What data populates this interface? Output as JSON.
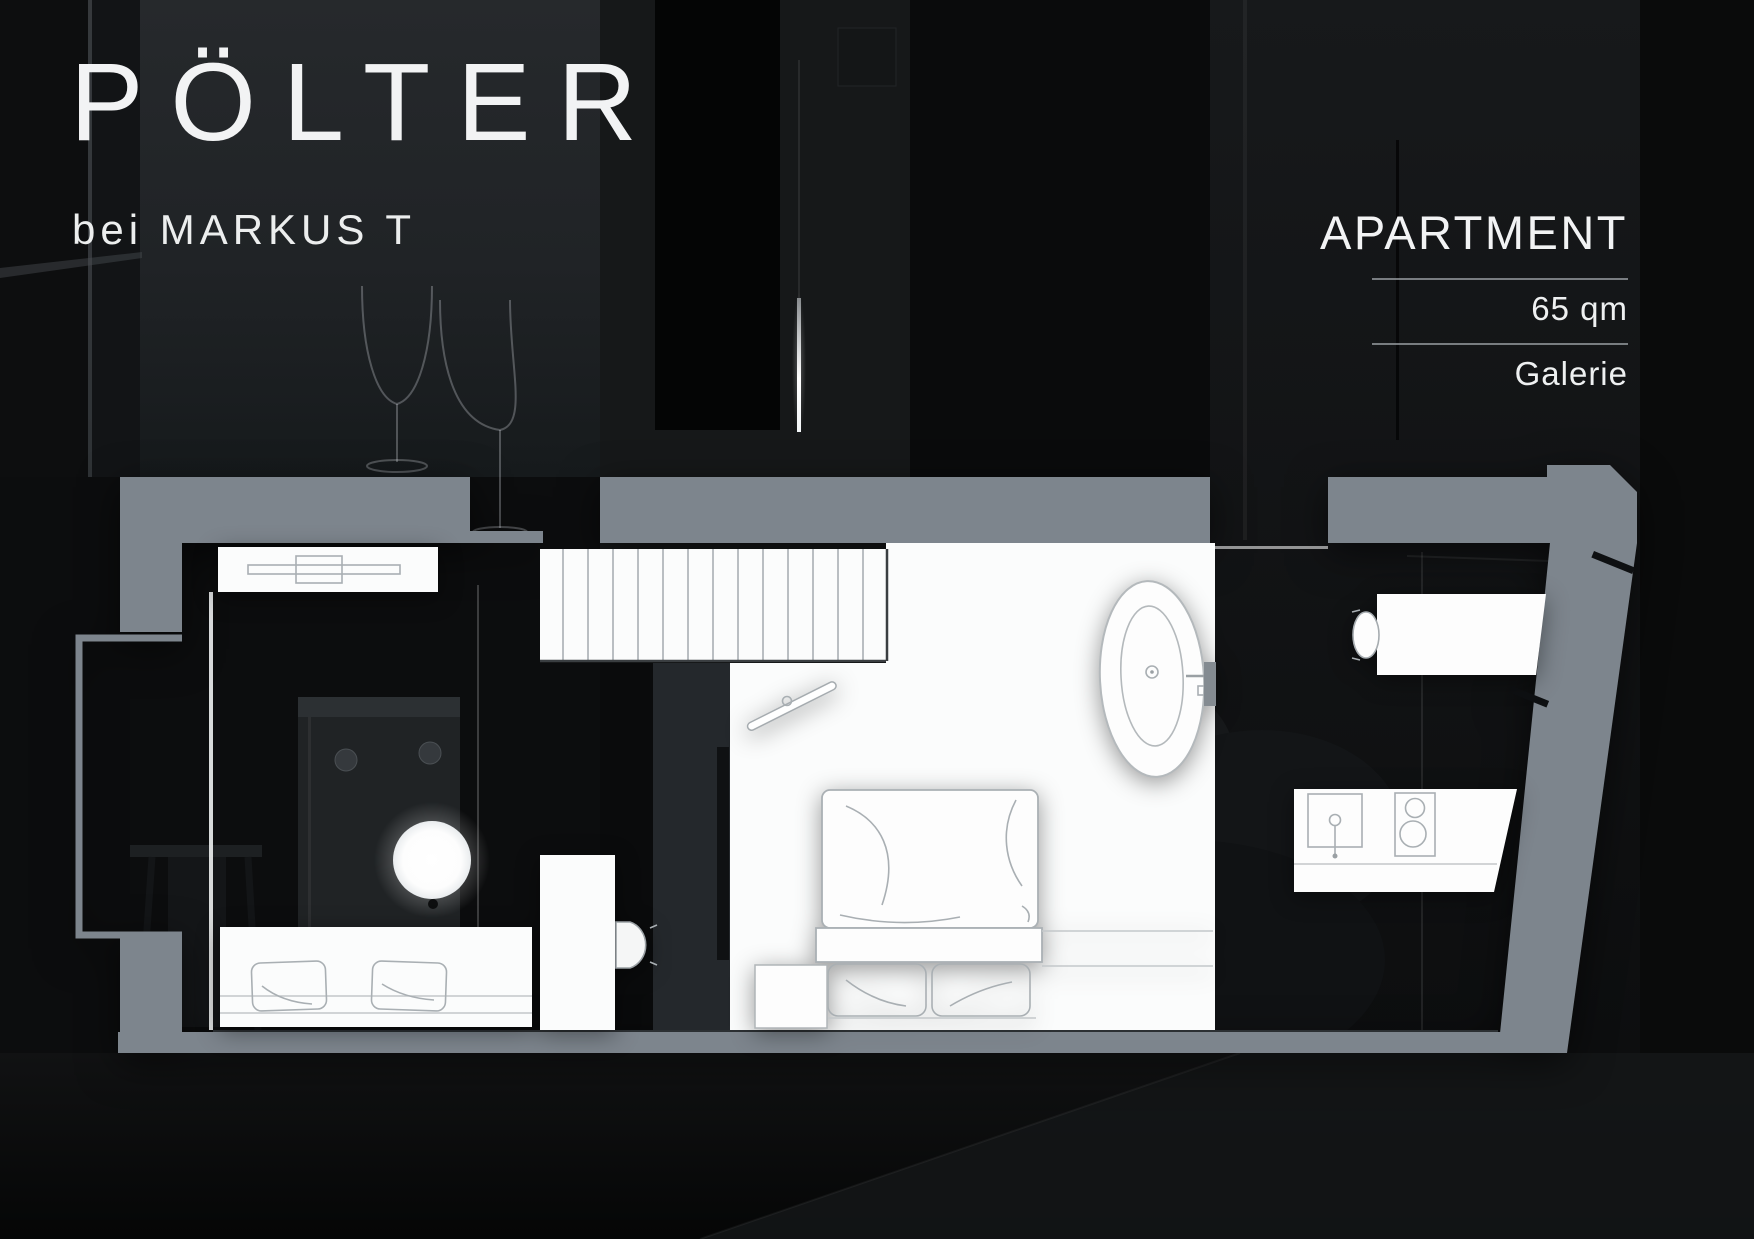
{
  "branding": {
    "title": "PÖLTER",
    "subtitle": "bei MARKUS T"
  },
  "info_panel": {
    "heading": "APARTMENT",
    "area": "65 qm",
    "level": "Galerie"
  },
  "colors": {
    "wall": "#7d858d",
    "background": "#0a0b0c",
    "text": "#f2f3f4",
    "divider": "#9ba0a4",
    "room_fill": "#fbfcfc",
    "sketch_line": "#a9afb3"
  },
  "floorplan": {
    "features": [
      "staircase",
      "sideboard",
      "sofa-with-cushions",
      "desk",
      "chair",
      "open-door",
      "double-bed-with-pillows",
      "bathtub",
      "wall-hung-toilet",
      "kitchenette-sink-cooktop",
      "bay-window",
      "glass-east-wall"
    ]
  }
}
